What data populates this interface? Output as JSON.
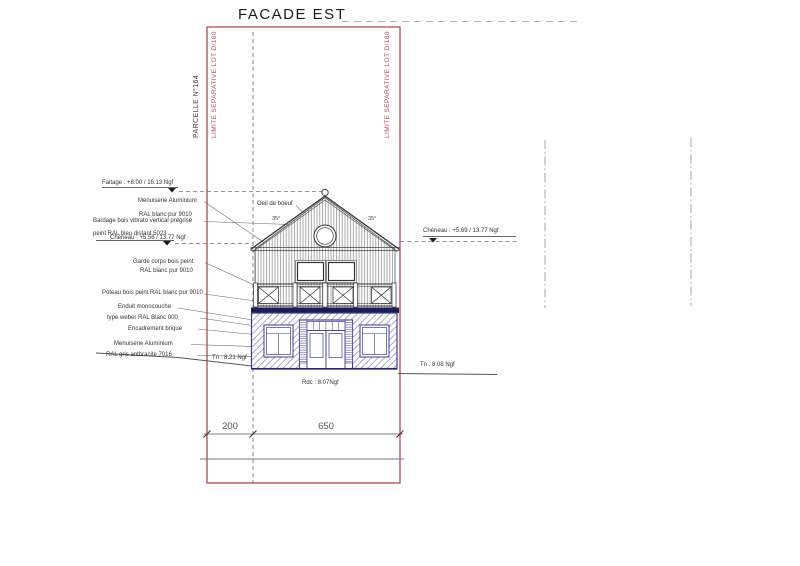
{
  "title": "FACADE EST",
  "boundaries": {
    "parcelle": "PARCELLE N°164",
    "limite_left": "LIMITE SEPARATIVE LOT D/180",
    "limite_right": "LIMITE SEPARATIVE LOT D/180"
  },
  "levels": {
    "faitage": "Faitage : +8.00 / 16.13 Ngf",
    "cheneau_left": "Chéneau : +5.56 / 13.77 Ngf",
    "cheneau_right": "Chéneau : +5.69 / 13.77 Ngf",
    "tn_left": "Tn : 8.21 Ngf",
    "tn_right": "Tn : 8.08 Ngf",
    "rdc": "Rdc : 8.07Ngf"
  },
  "callouts": {
    "upper": [
      "Menuiserie Aluminium",
      "RAL blanc pur 9010",
      "Bardage bois vibrato vertical prégrisé",
      "peint RAL bleu distant 5023"
    ],
    "balcony": [
      "Garde corps bois peint",
      "RAL blanc pur 9010"
    ],
    "poteau": "Poteau bois peint RAL blanc pur 9010",
    "ground": [
      "Enduit monocouche",
      "type weber RAL Blanc 000",
      "Encadrement brique",
      "Menuiserie Aluminium",
      "RAL gris anthracite 7016"
    ]
  },
  "roof": {
    "oeil_de_boeuf": "Oeil de boeuf",
    "pitch_left": "35°",
    "pitch_right": "35°"
  },
  "dimensions": {
    "left_offset": "200",
    "facade_width": "650"
  },
  "colors": {
    "boundary_red": "#b0494f",
    "plan_blue": "#3c3c94",
    "line_dark": "#444444"
  }
}
